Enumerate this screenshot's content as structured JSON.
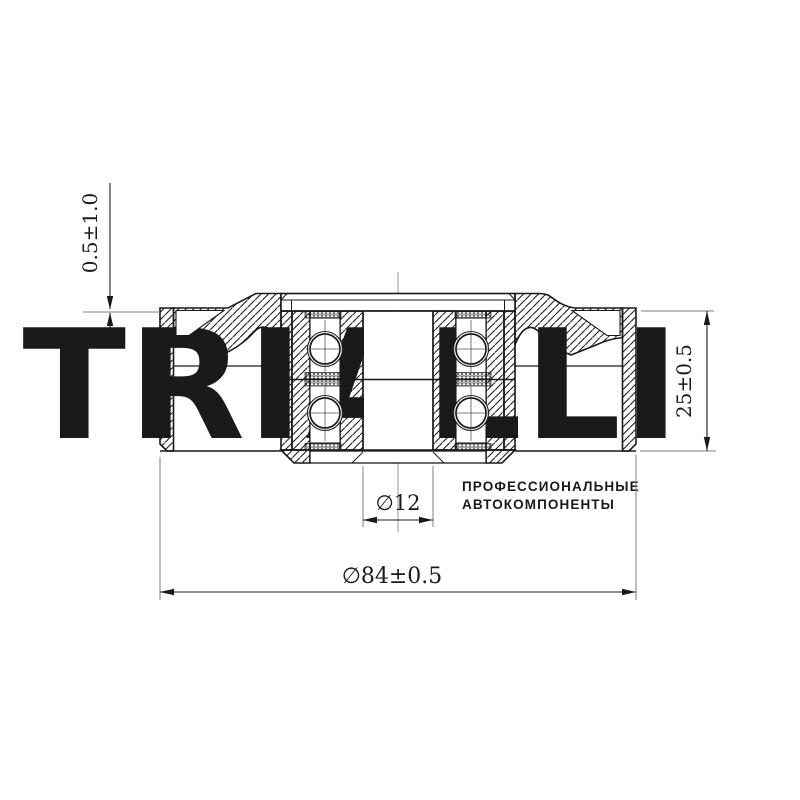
{
  "drawing": {
    "kind": "pulley-cross-section",
    "dimensions": {
      "face_offset": "0.5±1.0",
      "width": "25±0.5",
      "bore": "∅12",
      "outer_diameter": "∅84±0.5"
    },
    "watermark": {
      "logo": "TRIALLI",
      "tagline_line1": "ПРОФЕССИОНАЛЬНЫЕ",
      "tagline_line2": "АВТОКОМПОНЕНТЫ"
    },
    "colors": {
      "line": "#1a1a1a",
      "extension_line": "#808080",
      "centerline": "#999999",
      "watermark_logo": "#edeef0",
      "watermark_text": "#d8dadd",
      "background": "#ffffff"
    }
  }
}
